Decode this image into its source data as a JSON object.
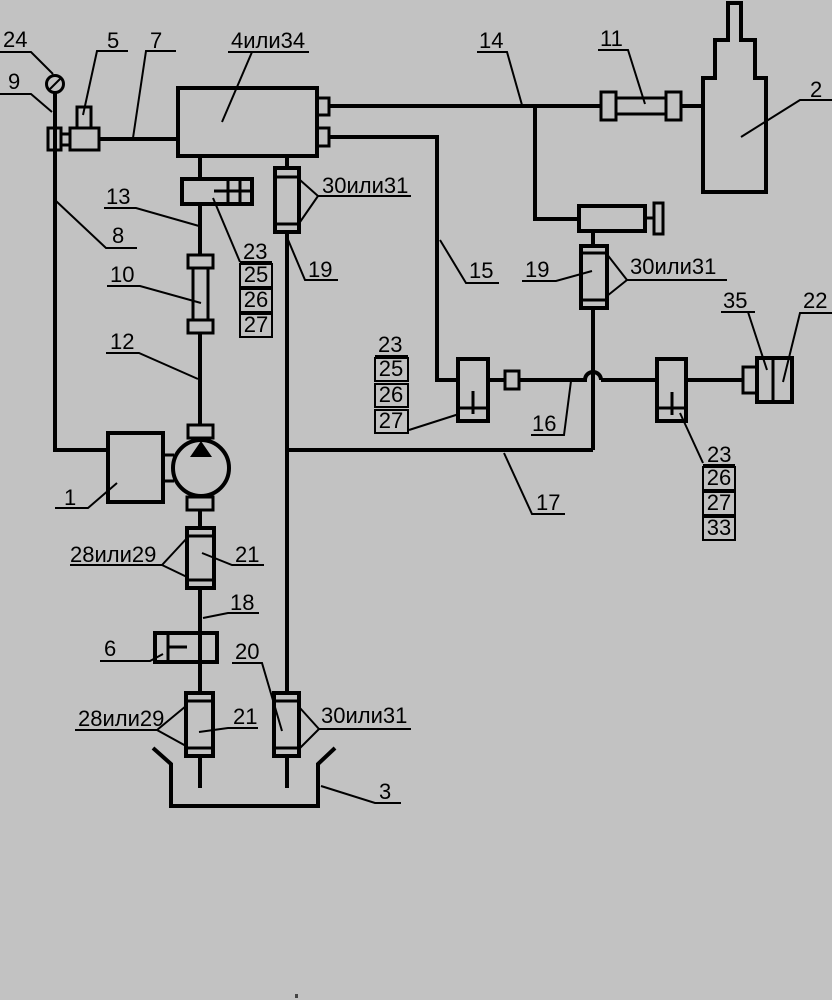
{
  "diagram": {
    "background": "#c2c2c2",
    "line_color": "#000000",
    "labels": {
      "k24": "24",
      "k9": "9",
      "k5": "5",
      "k7": "7",
      "k4": "4или34",
      "k14": "14",
      "k11": "11",
      "k2": "2",
      "k8": "8",
      "k13": "13",
      "k10": "10",
      "k12": "12",
      "k19a": "19",
      "k30a": "30или31",
      "k15": "15",
      "k19b": "19",
      "k30b": "30или31",
      "k35": "35",
      "k22": "22",
      "k16": "16",
      "k17": "17",
      "k1": "1",
      "k28a": "28или29",
      "k21a": "21",
      "k18": "18",
      "k6": "6",
      "k20": "20",
      "k28b": "28или29",
      "k21b": "21",
      "k30c": "30или31",
      "k3": "3"
    },
    "stacks": {
      "a": [
        "23",
        "25",
        "26",
        "27"
      ],
      "b": [
        "23",
        "25",
        "26",
        "27"
      ],
      "c": [
        "23",
        "26",
        "27",
        "33"
      ]
    }
  }
}
